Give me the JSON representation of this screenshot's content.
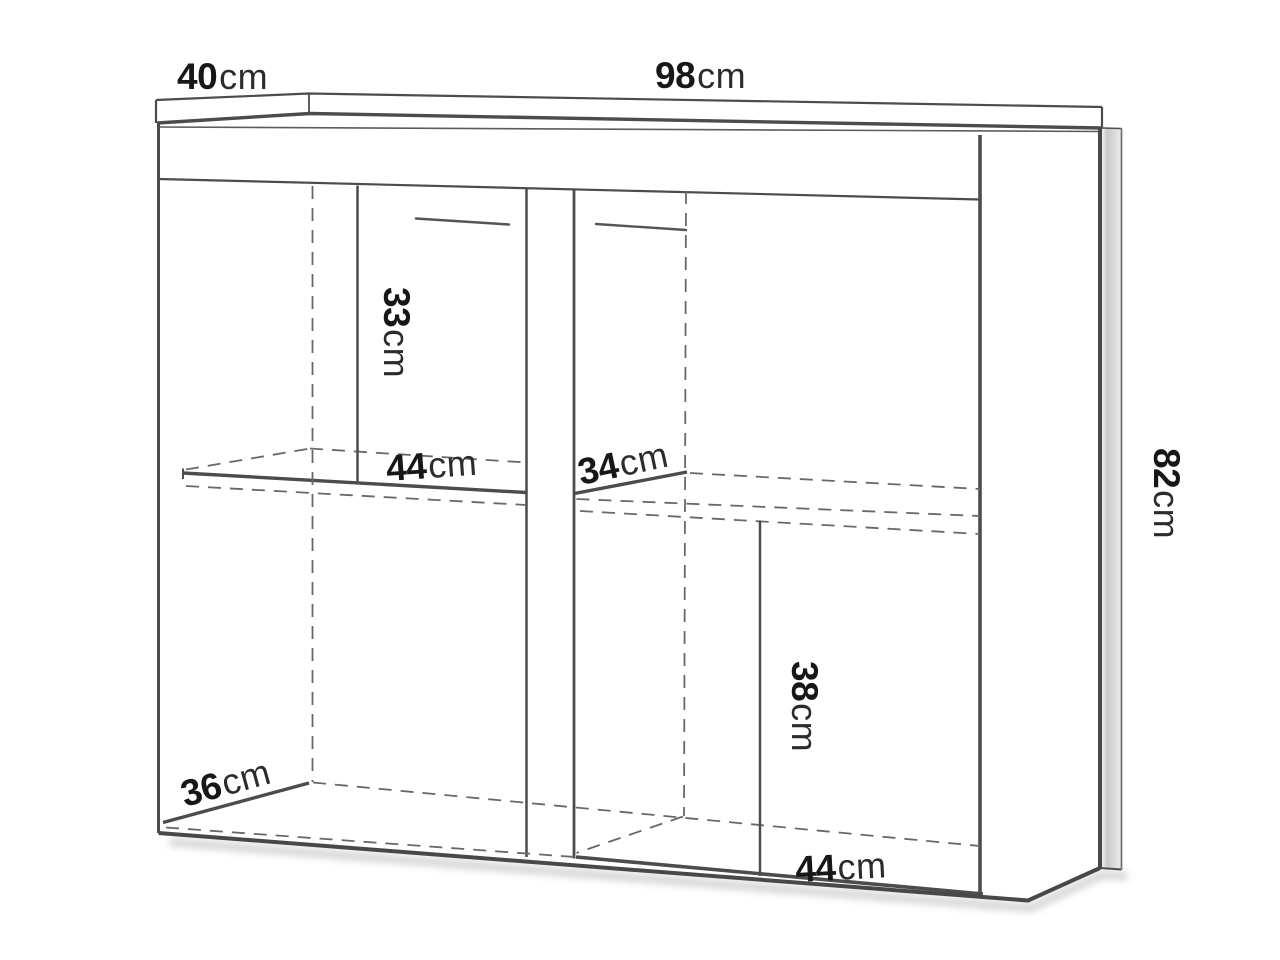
{
  "diagram": {
    "type": "furniture-dimension-drawing",
    "subject": "sideboard cabinet with shelves, oblique line drawing",
    "background_color": "#ffffff",
    "line_color": "#4c4c4c",
    "dashed_line_color": "#686868",
    "side_panel_shade": "#c9c9c9",
    "text_color": "#171717",
    "labels": {
      "top_depth": {
        "value": "40",
        "unit": "cm"
      },
      "top_width": {
        "value": "98",
        "unit": "cm"
      },
      "upper_compartment_height": {
        "value": "33",
        "unit": "cm"
      },
      "left_shelf_width": {
        "value": "44",
        "unit": "cm"
      },
      "right_shelf_depth": {
        "value": "34",
        "unit": "cm"
      },
      "overall_height": {
        "value": "82",
        "unit": "cm"
      },
      "lower_compartment_height": {
        "value": "38",
        "unit": "cm"
      },
      "bottom_left_depth": {
        "value": "36",
        "unit": "cm"
      },
      "bottom_right_width": {
        "value": "44",
        "unit": "cm"
      }
    }
  }
}
